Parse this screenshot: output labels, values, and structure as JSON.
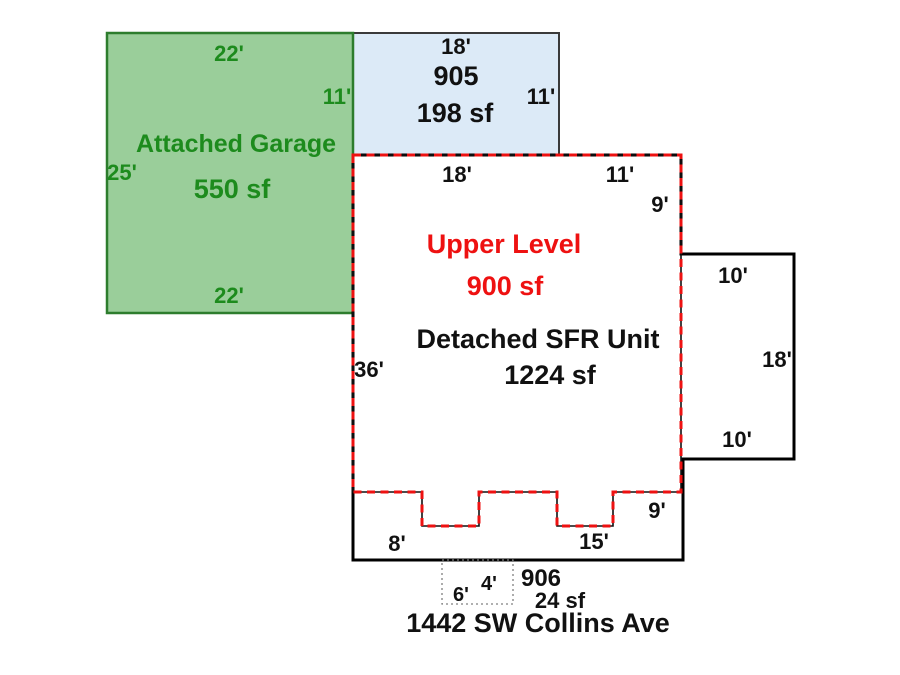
{
  "sketch": {
    "garage": {
      "name": "Attached Garage",
      "area": "550 sf",
      "dim_top": "22'",
      "dim_right": "11'",
      "dim_left": "25'",
      "dim_bottom": "22'"
    },
    "unit905": {
      "id": "905",
      "area": "198 sf",
      "dim_top": "18'",
      "dim_right": "11'"
    },
    "upper_level": {
      "name": "Upper Level",
      "area": "900 sf",
      "dim_top_left": "18'",
      "dim_top_right": "11'",
      "dim_right_top": "9'",
      "dim_left": "36'",
      "dim_bottom_left": "8'",
      "dim_bottom_right": "15'",
      "dim_bottom_corner": "9'"
    },
    "sfr": {
      "name": "Detached SFR Unit",
      "area": "1224 sf",
      "bump": {
        "dim_top": "10'",
        "dim_right": "18'",
        "dim_bottom": "10'"
      }
    },
    "unit906": {
      "id": "906",
      "area": "24 sf",
      "dim_width": "6'",
      "dim_gap": "4'"
    },
    "address": "1442 SW Collins Ave"
  },
  "colors": {
    "background": "#ffffff",
    "garage_fill": "#9ace9a",
    "garage_stroke": "#2d7d2d",
    "garage_text": "#1d8b1d",
    "unit905_fill": "#dceaf7",
    "unit905_stroke": "#3a3a3a",
    "sfr_stroke": "#000000",
    "upper_stroke": "#ee1111",
    "upper_under_stroke": "#111111",
    "unit906_stroke": "#808080",
    "text": "#111111"
  }
}
